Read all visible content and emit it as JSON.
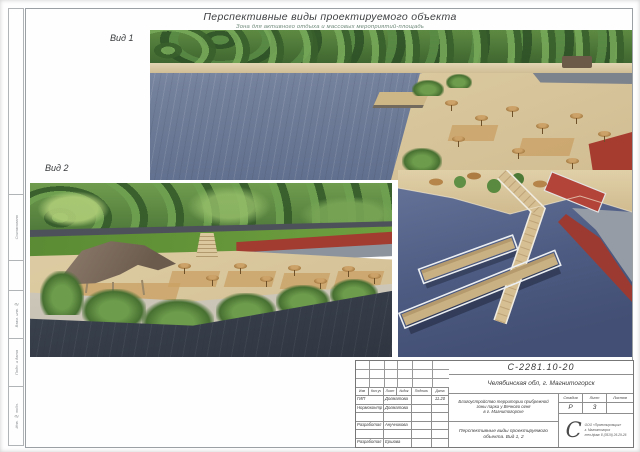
{
  "sheet": {
    "title": "Перспективные виды проектируемого объекта",
    "subtitle": "Зона для активного отдыха и массовых мероприятий-площадь"
  },
  "views": {
    "view1_label": "Вид 1",
    "view2_label": "Вид 2"
  },
  "margin_labels": {
    "agreed": "Согласовано",
    "vzam": "Взам. инв. №",
    "podp": "Подп. и дата",
    "inv": "Инв. № подл."
  },
  "stamp": {
    "doc_number": "С-2281.10-20",
    "location": "Челябинская обл, г. Магнитогорск",
    "header_cols": [
      "Изм",
      "Кол.уч",
      "Лист",
      "№док",
      "Подпись",
      "Дата"
    ],
    "rows": [
      {
        "role": "ГИП",
        "name": "Долматова",
        "date": "11.20"
      },
      {
        "role": "Нормоконтр",
        "name": "Долматова",
        "date": ""
      },
      {
        "role": "",
        "name": "",
        "date": ""
      },
      {
        "role": "Разработал",
        "name": "Анучникова",
        "date": ""
      },
      {
        "role": "",
        "name": "",
        "date": ""
      },
      {
        "role": "Разработал",
        "name": "Ершова",
        "date": ""
      }
    ],
    "project_line1": "Благоустройство территории прибрежной",
    "project_line2": "зоны парка у Вечного огня",
    "project_line3": "в г. Магнитогорске",
    "sheet_title_line1": "Перспективные виды проектируемого",
    "sheet_title_line2": "объекта. Вид 1, 2",
    "stage_label": "Стадия",
    "list_label": "Лист",
    "listov_label": "Листов",
    "stage_value": "Р",
    "list_value": "3",
    "listov_value": "",
    "logo_letter": "С",
    "logo_line1": "ООО «Проектировщик»",
    "logo_line2": "г. Магнитогорск",
    "logo_line3": "тел./факс 8 (3519) 26-29-26"
  },
  "colors": {
    "water_view1": "#6e7c98",
    "water_dark": "#3c4452",
    "sand": "#d8c6a0",
    "deck_wood": "#c49a62",
    "tree_green": "#4c7a34",
    "lawn_green": "#5d8c36",
    "track_red": "#a63c30",
    "canopy_brown": "#7a695b"
  }
}
